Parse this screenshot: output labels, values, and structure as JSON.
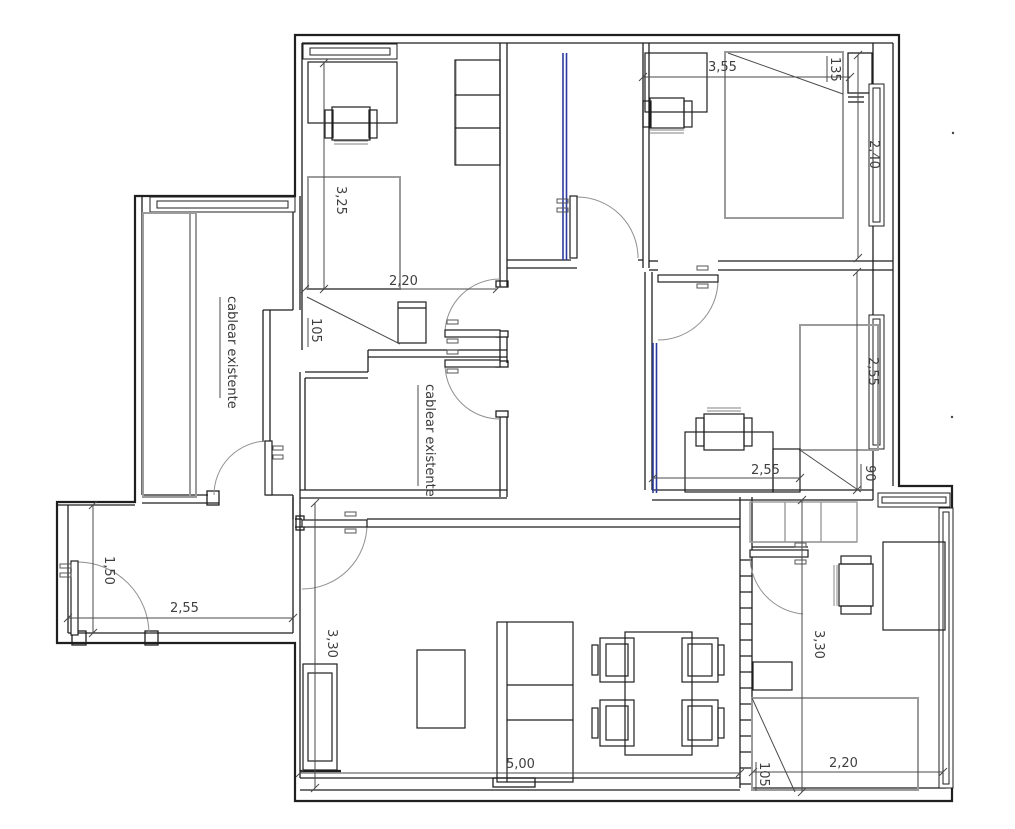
{
  "drawing": {
    "type": "floor-plan",
    "language": "es",
    "notes": {
      "dressing_room": "cablear existente",
      "inner_room": "cablear existente"
    },
    "dimensions": {
      "bedroom1_width": "3,55",
      "bedroom1_recess": "135",
      "bedroom1_window": "2,40",
      "office_depth": "3,25",
      "office_width": "2,20",
      "office_strip": "105",
      "bedroom2_window": "2,55",
      "bedroom2_width": "2,55",
      "bedroom2_recess": "90",
      "entry_depth": "1,50",
      "entry_width": "2,55",
      "living_depth": "3,30",
      "living_width": "5,00",
      "bedroom3_depth": "3,30",
      "bedroom3_width": "2,20",
      "bedroom3_strip": "105"
    },
    "colors": {
      "background": "#ffffff",
      "wall": "#1f1f1f",
      "furniture_gray": "#9b9b9b",
      "cable_blue": "#2b3a9e",
      "door_arc": "#8f8f8f",
      "dimension": "#4a4a4a"
    }
  }
}
